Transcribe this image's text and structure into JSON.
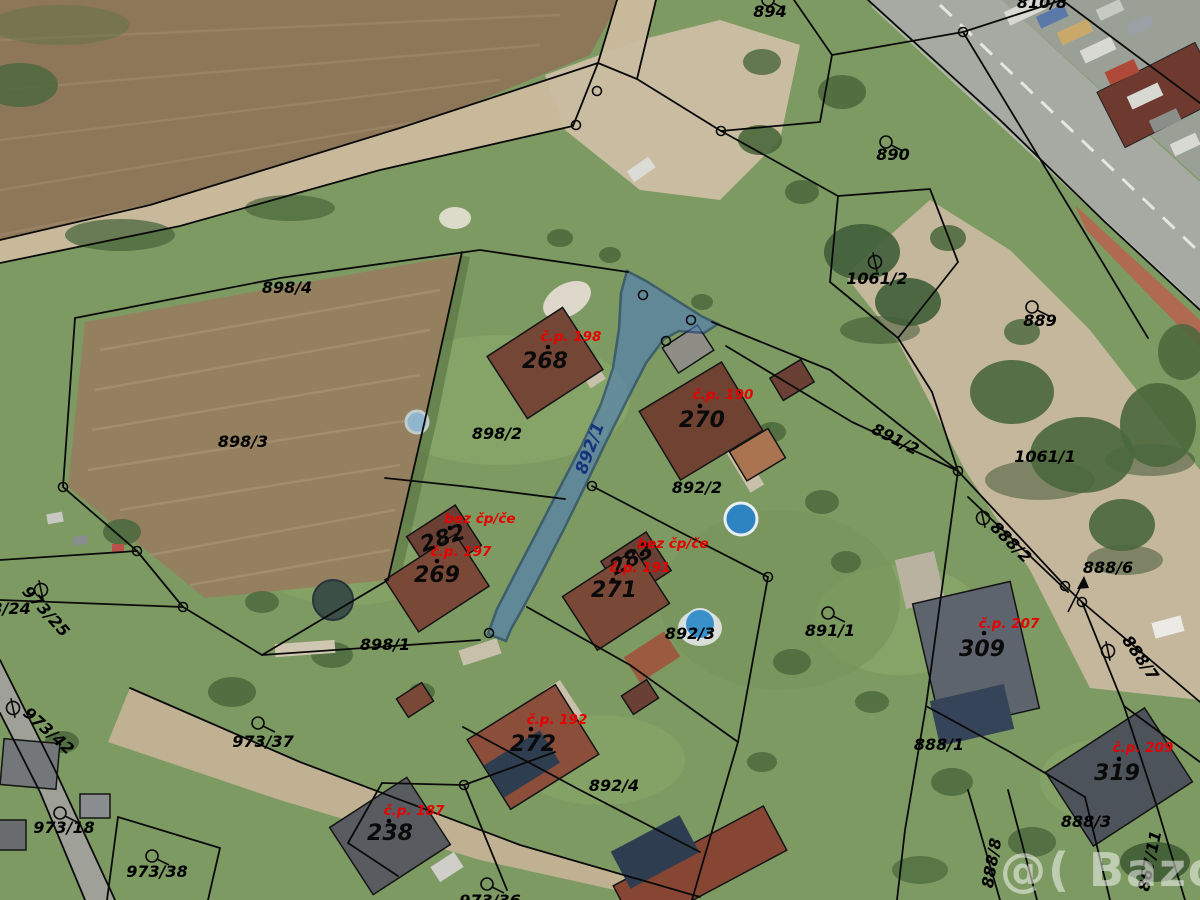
{
  "map": {
    "watermark_text": "@( Bazos.cz",
    "highlighted_parcel": "892/1",
    "colors": {
      "parcel_highlight_fill": "#4e7dbb",
      "parcel_highlight_stroke": "#15376f",
      "boundary_line": "#0a0a0a",
      "parcel_label": "#000000",
      "building_label": "#000000",
      "house_number_label": "#e60000",
      "highlighted_parcel_label": "#16337d",
      "road": "#a7a9a3",
      "field": "#94805f",
      "grass": "#7d9a62"
    },
    "parcel_labels": [
      "894",
      "890",
      "1061/2",
      "889",
      "810/8",
      "898/4",
      "898/3",
      "898/2",
      "892/1",
      "892/2",
      "891/2",
      "1061/1",
      "888/2",
      "888/6",
      "888/7",
      "898/1",
      "892/3",
      "891/1",
      "888/1",
      "892/4",
      "888/3",
      "888/8",
      "867/11",
      "973/24",
      "973/25",
      "973/42",
      "973/37",
      "973/18",
      "973/38",
      "973/36"
    ],
    "building_numbers": [
      "268",
      "270",
      "282",
      "269",
      "283",
      "271",
      "272",
      "238",
      "309",
      "319"
    ],
    "house_number_labels": [
      "č.p. 198",
      "č.p. 190",
      "bez čp/če",
      "č.p. 197",
      "bez čp/če",
      "č.p. 191",
      "č.p. 192",
      "č.p. 187",
      "č.p. 207",
      "č.p. 209"
    ]
  }
}
